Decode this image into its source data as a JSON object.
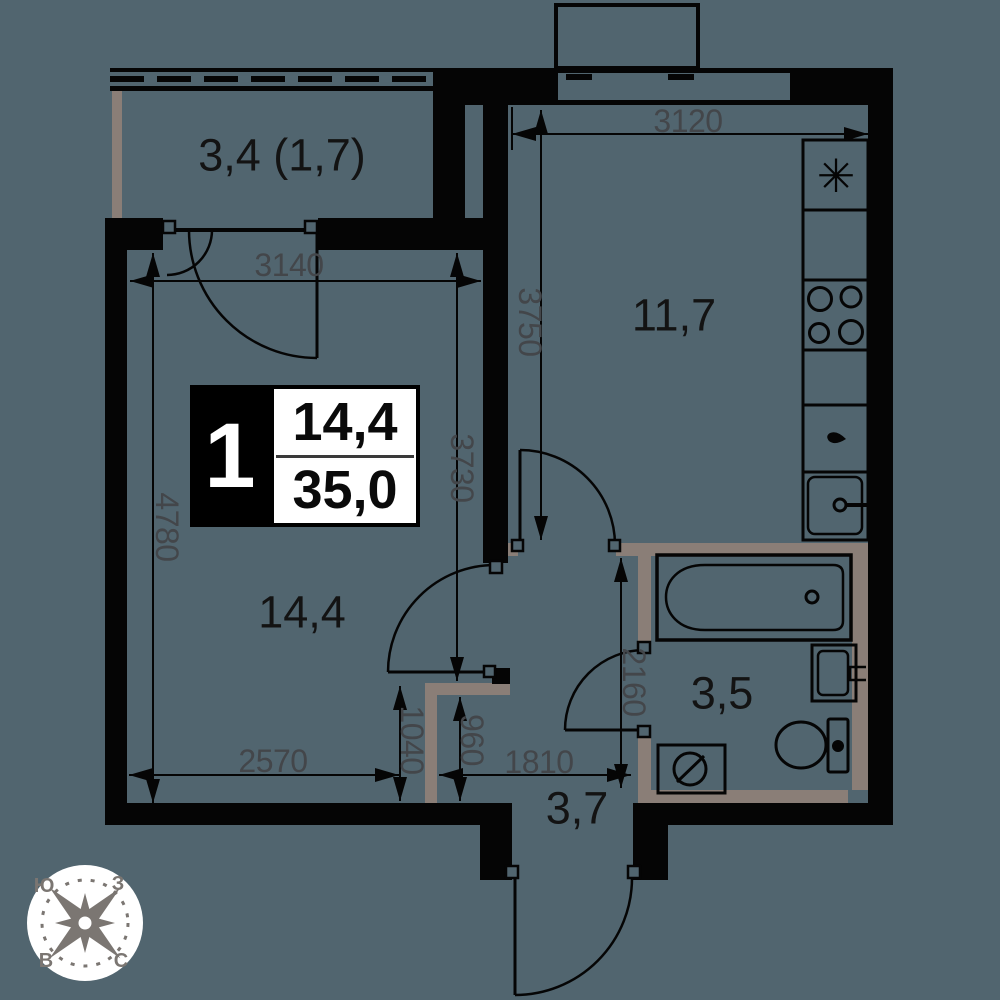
{
  "colors": {
    "background": "#51656f",
    "wall": "#050505",
    "partition": "#8a7e77",
    "dimension_text": "#43464a",
    "label_text": "#131313",
    "info_panel_bg": "#ffffff",
    "info_panel_block": "#000000",
    "compass_bg": "#ffffff",
    "compass_glyph": "#7b7672"
  },
  "rooms": {
    "balcony": "3,4 (1,7)",
    "kitchen": "11,7",
    "living": "14,4",
    "bathroom": "3,5",
    "hallway": "3,7"
  },
  "info": {
    "room_count": "1",
    "living_area": "14,4",
    "total_area": "35,0"
  },
  "dims": {
    "w3140": "3140",
    "w3120": "3120",
    "w2570": "2570",
    "w1810": "1810",
    "h4780": "4780",
    "h3730": "3730",
    "h3750": "3750",
    "h2160": "2160",
    "h1040": "1040",
    "h960": "960"
  },
  "compass": {
    "top_left": "Ю",
    "top_right": "З",
    "bottom_left": "В",
    "bottom_right": "С"
  },
  "fixtures": {
    "kitchen": [
      "refrigerator",
      "stove-4-burners",
      "kitchen-sink"
    ],
    "bathroom": [
      "bathtub",
      "washbasin",
      "toilet",
      "washing-machine"
    ]
  }
}
